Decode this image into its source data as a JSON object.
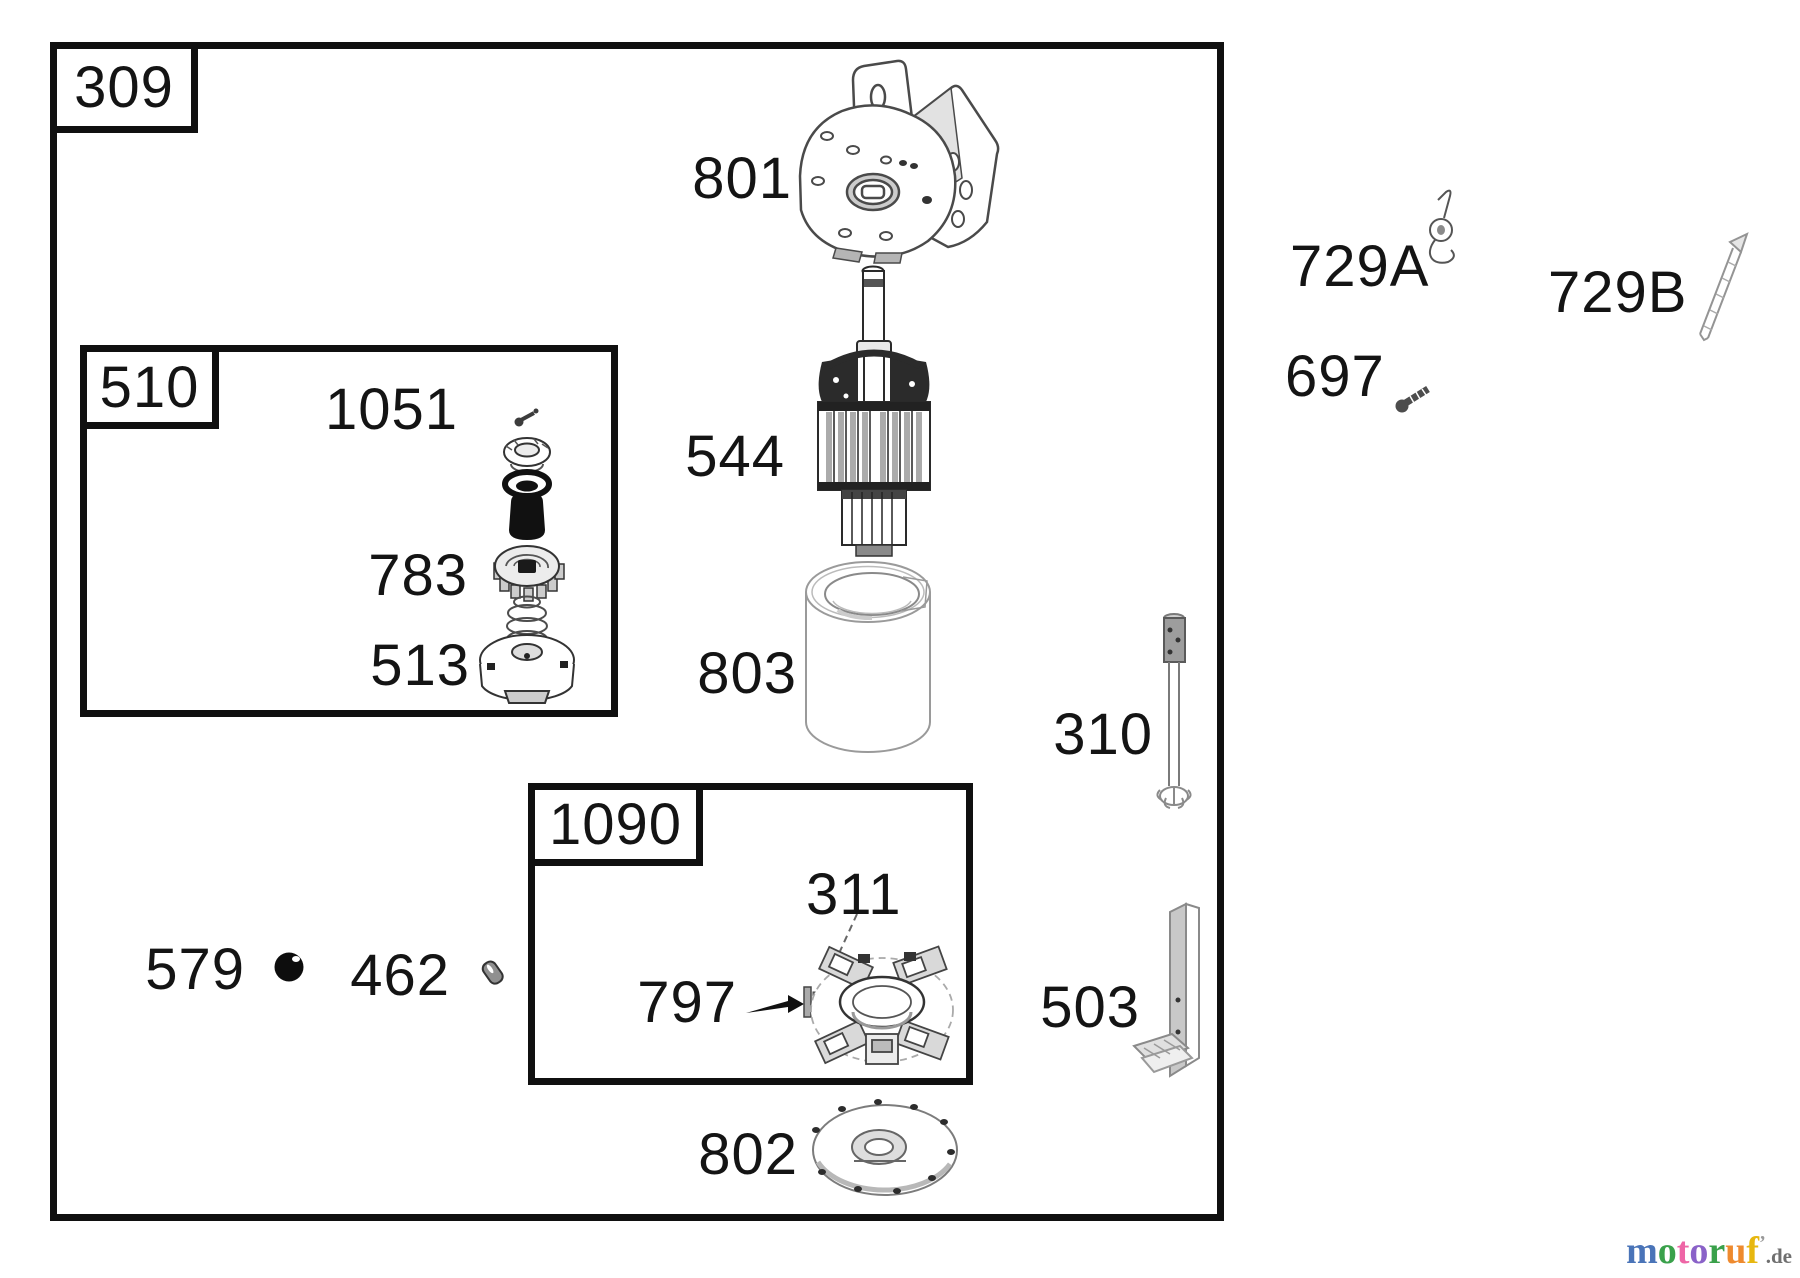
{
  "frames": {
    "main": {
      "label": "309"
    },
    "gear_group": {
      "label": "510"
    },
    "brush_group": {
      "label": "1090"
    }
  },
  "callouts": {
    "end_cap_bracket": "801",
    "armature": "544",
    "housing": "803",
    "end_cap_plate": "802",
    "gear_kit": "1051",
    "pinion_gear": "783",
    "clutch_retainer": "513",
    "brush_terminal": "311",
    "brush_assembly": "797",
    "ball": "579",
    "roll_pin": "462",
    "through_bolt": "310",
    "bracket": "503",
    "clip_a": "729A",
    "clip_b": "729B",
    "screw": "697"
  },
  "watermark": {
    "letters": [
      {
        "char": "m",
        "color": "#4a74b8"
      },
      {
        "char": "o",
        "color": "#3aa14b"
      },
      {
        "char": "t",
        "color": "#ee66a6"
      },
      {
        "char": "o",
        "color": "#8a62c8"
      },
      {
        "char": "r",
        "color": "#3aa14b"
      },
      {
        "char": "u",
        "color": "#ee8a2e"
      },
      {
        "char": "f",
        "color": "#e7b70f"
      }
    ],
    "tick": "’",
    "suffix": ".de"
  }
}
